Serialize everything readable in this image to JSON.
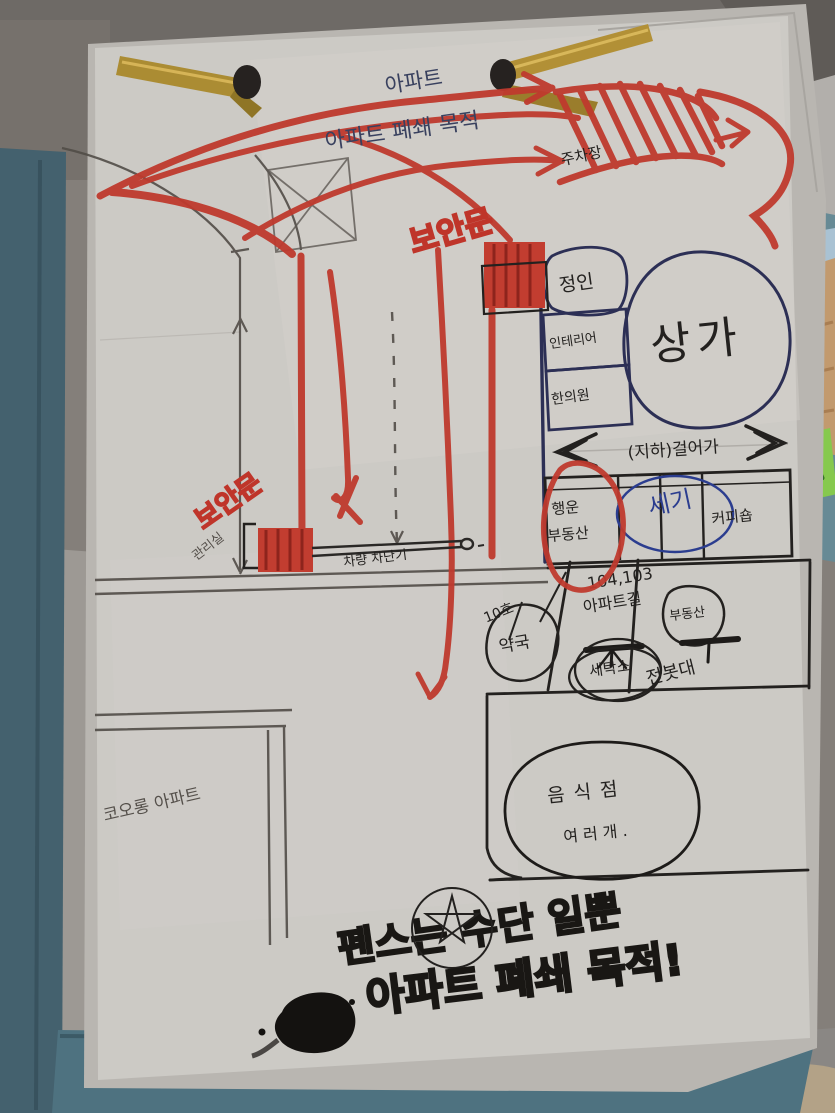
{
  "colors": {
    "paper": "#cccac5",
    "clipboard_teal": "#4a6b78",
    "marker_red": "#c0392b",
    "ink_dark": "#23211f",
    "ballpoint_blue": "#39415f",
    "shop_blue": "#2b3d8f",
    "brass_gold": "#b08f33",
    "green_tab": "#86c94e"
  },
  "top_notes": {
    "apartment": "아파트",
    "closure_purpose": "아파트 폐쇄 목적",
    "parking": "주차장"
  },
  "gates": {
    "top_gate_label": "보안문",
    "left_gate_label": "보안문",
    "management_office": "관리실",
    "barrier_label": "차량 차단기"
  },
  "mall": {
    "circle_label": "상가",
    "box1": "정인",
    "box2": "인테리어",
    "box3": "한의원",
    "underground_note": "(지하)걸어가"
  },
  "shops_row": {
    "shop1_line1": "행운",
    "shop1_line2": "부동산",
    "shop_mid": "세기",
    "shop_coffee": "커피숍"
  },
  "street_labels": {
    "apt_numbers": "104,103",
    "apt_road": "아파트길",
    "realty": "부동산",
    "unit": "10호",
    "pharmacy": "약국",
    "laundry": "세탁소",
    "pole": "전봇대"
  },
  "blocks": {
    "kolon_apartment": "코오롱 아파트",
    "restaurants_line1": "음식점",
    "restaurants_line2": "여러개."
  },
  "slogan": {
    "line1": "펜스는 수단 일뿐",
    "line2": "아파트 폐쇄 목적!"
  }
}
